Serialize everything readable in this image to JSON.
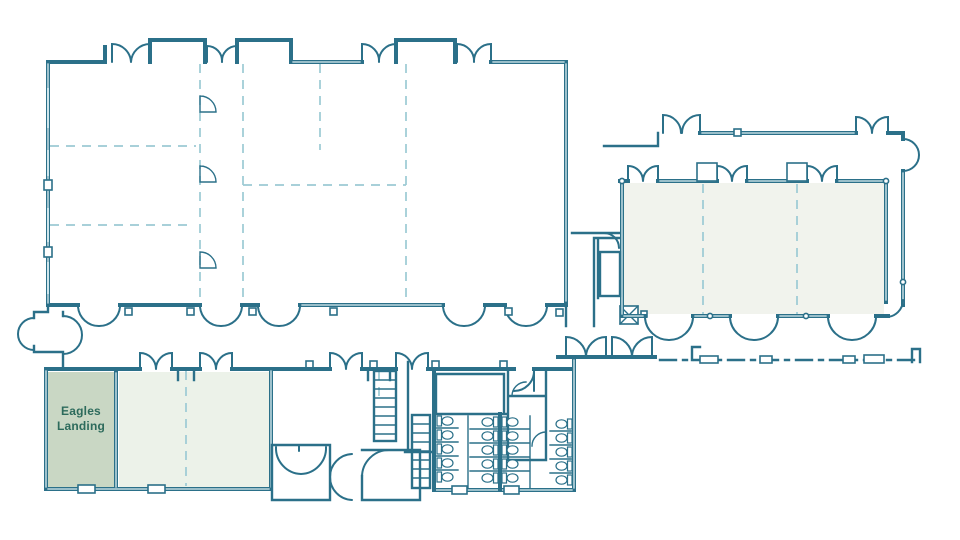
{
  "floor_plan": {
    "highlighted_room": {
      "label": "Eagles Landing"
    },
    "colors": {
      "wall": "#2b7089",
      "partition_dash": "#9ccad4",
      "highlight_fill": "#c9d7c4",
      "room_fill": "#ecf2e9",
      "room_fill_east": "#f1f3ed",
      "label_text": "#2d6b5c",
      "background": "#ffffff"
    }
  }
}
